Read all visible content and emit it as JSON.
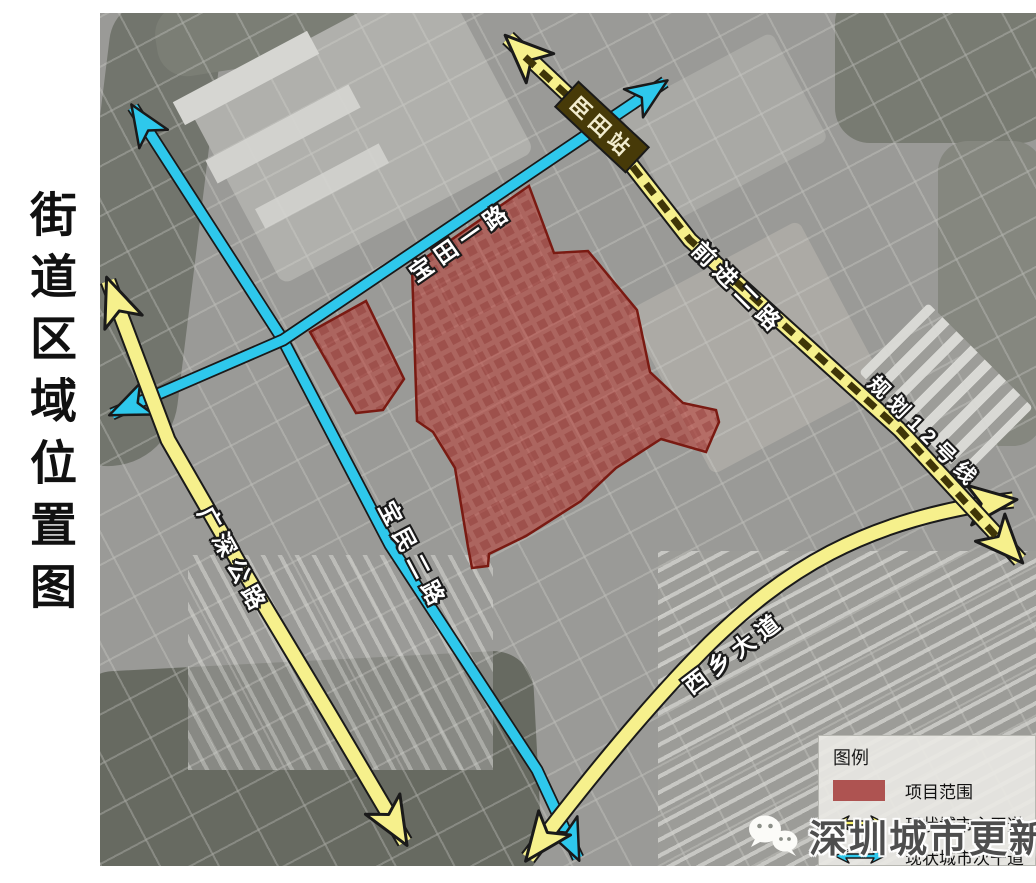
{
  "title": "街道区域位置图",
  "roads": {
    "baotian_yilu": "宝田一路",
    "baomin_erlu": "宝民二路",
    "guangshen_gonglu": "广深公路",
    "qianjin_erlu": "前进二路",
    "planned_line12": "规划12号线",
    "station_chentian": "臣田站",
    "xixiang_dadao": "西乡大道"
  },
  "legend": {
    "title": "图例",
    "items": [
      {
        "label": "项目范围",
        "swatch": "red-area-swatch"
      },
      {
        "label": "现状城市主干道",
        "swatch": "yellow-double-arrow"
      },
      {
        "label": "现状城市次干道",
        "swatch": "blue-double-arrow"
      }
    ]
  },
  "watermark": {
    "text": "深圳城市更新专家",
    "icon": "wechat-icon"
  },
  "colors": {
    "main_road_yellow": "#f6f08c",
    "secondary_road_blue": "#2ec8ec",
    "project_area_red": "#c24a44",
    "project_area_outline": "#7a1a12",
    "metro_dash": "#3f3508",
    "station_bg": "#473a08"
  }
}
